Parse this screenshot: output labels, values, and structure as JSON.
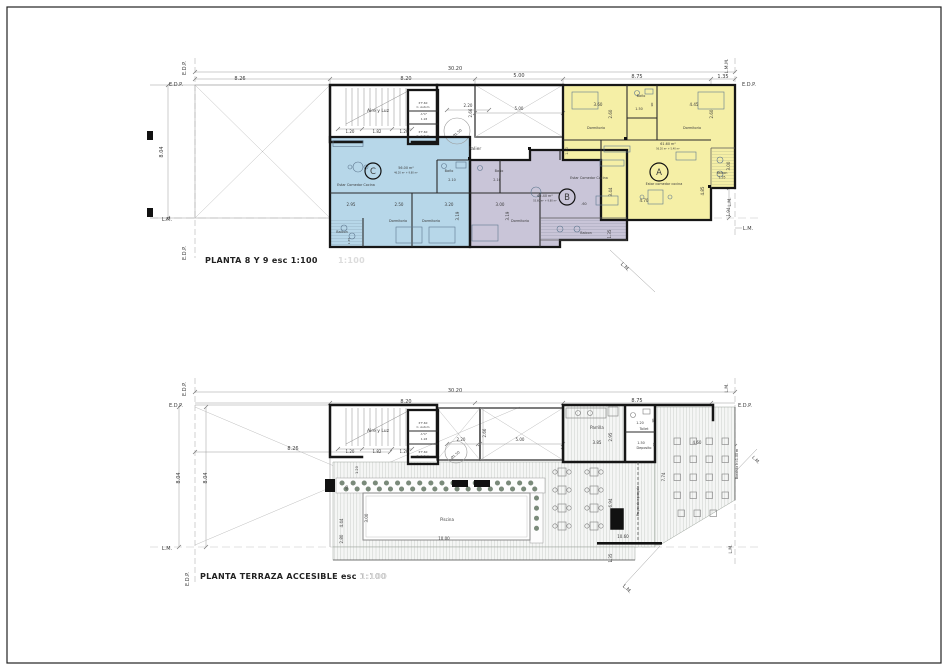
{
  "sheet": {
    "type_note": "architectural floor plan sheet",
    "colors": {
      "unit_a": "#f5efa6",
      "unit_b": "#c9c5d8",
      "unit_c": "#b7d7e9",
      "wall": "#161616",
      "text": "#3a3a3a",
      "ghost": "#dcdcdc"
    }
  },
  "plan1": {
    "title": "PLANTA 8 Y 9 esc 1:100",
    "ghost": "1:100",
    "units": [
      {
        "id": "A",
        "area": "61.60 m²",
        "living": "Estar comedor cocina"
      },
      {
        "id": "B",
        "area": "65.40 m²",
        "living": "Estar Comedor Cocina"
      },
      {
        "id": "C",
        "area": "56.00 m²",
        "living": "Estar Comedor Cocina"
      }
    ],
    "annotations": [
      {
        "t": "E.D.P.",
        "x": 176,
        "y": 86,
        "s": 5
      },
      {
        "t": "E.D.P.",
        "x": 186,
        "y": 68,
        "s": 5,
        "r": -90
      },
      {
        "t": "30.20",
        "x": 455,
        "y": 70,
        "s": 5
      },
      {
        "t": "8.26",
        "x": 240,
        "y": 80,
        "s": 5
      },
      {
        "t": "8.20",
        "x": 406,
        "y": 80,
        "s": 5
      },
      {
        "t": "5.00",
        "x": 519,
        "y": 77,
        "s": 5
      },
      {
        "t": "8.75",
        "x": 637,
        "y": 78,
        "s": 5
      },
      {
        "t": "1.35",
        "x": 723,
        "y": 78,
        "s": 5
      },
      {
        "t": "E.D.P.",
        "x": 749,
        "y": 86,
        "s": 5
      },
      {
        "t": "L.M.M.",
        "x": 728,
        "y": 66,
        "s": 4.5,
        "r": -90
      },
      {
        "t": "8.04",
        "x": 163,
        "y": 152,
        "s": 5,
        "r": -90
      },
      {
        "t": "L.M.",
        "x": 167,
        "y": 221,
        "s": 5
      },
      {
        "t": "E.D.P.",
        "x": 186,
        "y": 253,
        "s": 5,
        "r": -90
      },
      {
        "t": "3.00",
        "x": 730,
        "y": 166,
        "s": 4,
        "r": -90
      },
      {
        "t": "L.M.",
        "x": 731,
        "y": 202,
        "s": 4.5,
        "r": -90
      },
      {
        "t": "1.94",
        "x": 730,
        "y": 212,
        "s": 4,
        "r": -90
      },
      {
        "t": "L.M.",
        "x": 748,
        "y": 230,
        "s": 5
      },
      {
        "t": "L.M.",
        "x": 624,
        "y": 268,
        "s": 5,
        "r": 45
      },
      {
        "t": "Aire y Luz",
        "x": 378,
        "y": 112,
        "s": 4.5
      },
      {
        "t": "1.20",
        "x": 350,
        "y": 133,
        "s": 4
      },
      {
        "t": "1.82",
        "x": 377,
        "y": 133,
        "s": 4
      },
      {
        "t": "1.20",
        "x": 404,
        "y": 133,
        "s": 4
      },
      {
        "t": "P F-60",
        "x": 423,
        "y": 104,
        "s": 2.8
      },
      {
        "t": "C. Autom",
        "x": 423,
        "y": 108,
        "s": 2.8
      },
      {
        "t": "A°C°",
        "x": 424,
        "y": 115,
        "s": 2.8
      },
      {
        "t": "1.18",
        "x": 424,
        "y": 120,
        "s": 2.8
      },
      {
        "t": "P F-60",
        "x": 423,
        "y": 133,
        "s": 2.8
      },
      {
        "t": "C. Autom",
        "x": 423,
        "y": 137,
        "s": 2.8
      },
      {
        "t": "2.20",
        "x": 468,
        "y": 107,
        "s": 4
      },
      {
        "t": "Ø1.50",
        "x": 458,
        "y": 134,
        "s": 3.5,
        "r": -40
      },
      {
        "t": "2.66",
        "x": 472,
        "y": 113,
        "s": 4,
        "r": -90
      },
      {
        "t": "5.00",
        "x": 519,
        "y": 110,
        "s": 4
      },
      {
        "t": "Palier",
        "x": 475,
        "y": 150,
        "s": 4.5
      },
      {
        "t": "C",
        "x": 373,
        "y": 174,
        "s": 8.5
      },
      {
        "t": "56.00 m²",
        "x": 406,
        "y": 169,
        "s": 3.4
      },
      {
        "t": "46.20 m² + 9.80 m²",
        "x": 406,
        "y": 173.5,
        "s": 2.4,
        "c": "#8a8a8a"
      },
      {
        "t": "Estar Comedor Cocina",
        "x": 356,
        "y": 186,
        "s": 3.4
      },
      {
        "t": "2.95",
        "x": 351,
        "y": 206,
        "s": 4
      },
      {
        "t": "2.50",
        "x": 399,
        "y": 206,
        "s": 4
      },
      {
        "t": "3.20",
        "x": 449,
        "y": 206,
        "s": 4
      },
      {
        "t": "Dormitorio",
        "x": 398,
        "y": 222,
        "s": 3.4
      },
      {
        "t": "Dormitorio",
        "x": 431,
        "y": 222,
        "s": 3.4
      },
      {
        "t": "3.19",
        "x": 459,
        "y": 216,
        "s": 4,
        "r": -90
      },
      {
        "t": "Baño",
        "x": 449,
        "y": 172,
        "s": 3.4
      },
      {
        "t": "2.10",
        "x": 452,
        "y": 181,
        "s": 3.4
      },
      {
        "t": "Balcon",
        "x": 342,
        "y": 233,
        "s": 3.4
      },
      {
        "t": "1.35",
        "x": 350,
        "y": 241,
        "s": 3,
        "r": -90
      },
      {
        "t": "Baño",
        "x": 499,
        "y": 172,
        "s": 3.4
      },
      {
        "t": "2.10",
        "x": 497,
        "y": 181,
        "s": 3.4
      },
      {
        "t": "Estar Comedor Cocina",
        "x": 589,
        "y": 179,
        "s": 3.4
      },
      {
        "t": "65.40 m²",
        "x": 545,
        "y": 197,
        "s": 3.4
      },
      {
        "t": "55.60 m² + 9.80 m²",
        "x": 545,
        "y": 201.5,
        "s": 2.4,
        "c": "#8a8a8a"
      },
      {
        "t": "B",
        "x": 567,
        "y": 200,
        "s": 8.5
      },
      {
        "t": ".60",
        "x": 584,
        "y": 205,
        "s": 3.4
      },
      {
        "t": "3.44",
        "x": 612,
        "y": 192,
        "s": 4,
        "r": -90
      },
      {
        "t": "3.00",
        "x": 500,
        "y": 206,
        "s": 4
      },
      {
        "t": "3.19",
        "x": 509,
        "y": 216,
        "s": 4,
        "r": -90
      },
      {
        "t": "Dormitorio",
        "x": 520,
        "y": 222,
        "s": 3.4
      },
      {
        "t": "Balcon",
        "x": 586,
        "y": 234,
        "s": 3.4
      },
      {
        "t": "1.35",
        "x": 611,
        "y": 234,
        "s": 4,
        "r": -90
      },
      {
        "t": "3.60",
        "x": 598,
        "y": 106,
        "s": 4
      },
      {
        "t": "2.60",
        "x": 612,
        "y": 114,
        "s": 4,
        "r": -90
      },
      {
        "t": "Dormitorio",
        "x": 596,
        "y": 129,
        "s": 3.4
      },
      {
        "t": "Baño",
        "x": 641,
        "y": 97,
        "s": 3.4
      },
      {
        "t": "1.50",
        "x": 639,
        "y": 110,
        "s": 3.4
      },
      {
        "t": ".90",
        "x": 653,
        "y": 105,
        "s": 3,
        "r": -90
      },
      {
        "t": "4.45",
        "x": 694,
        "y": 106,
        "s": 4
      },
      {
        "t": "2.60",
        "x": 713,
        "y": 114,
        "s": 4,
        "r": -90
      },
      {
        "t": "Dormitorio",
        "x": 692,
        "y": 129,
        "s": 3.4
      },
      {
        "t": "61.60 m²",
        "x": 668,
        "y": 145,
        "s": 3.4
      },
      {
        "t": "56.20 m² + 5.40 m²",
        "x": 668,
        "y": 149.5,
        "s": 2.4,
        "c": "#8a8a8a"
      },
      {
        "t": "A",
        "x": 659,
        "y": 175,
        "s": 8.5
      },
      {
        "t": "Estar comedor cocina",
        "x": 664,
        "y": 185,
        "s": 3.4
      },
      {
        "t": "4.70",
        "x": 644,
        "y": 202,
        "s": 4
      },
      {
        "t": "4.85",
        "x": 704,
        "y": 191,
        "s": 4,
        "r": -90
      },
      {
        "t": "Balcon",
        "x": 722,
        "y": 174,
        "s": 3.2
      },
      {
        "t": "1.35",
        "x": 722,
        "y": 178.5,
        "s": 3.2
      },
      {
        "t": "1.50",
        "x": 568,
        "y": 151,
        "s": 3.4,
        "r": -90
      }
    ]
  },
  "plan2": {
    "title": "PLANTA TERRAZA ACCESIBLE esc 1:100",
    "ghost": "1:100",
    "annotations": [
      {
        "t": "E.D.P.",
        "x": 186,
        "y": 389,
        "s": 5,
        "r": -90
      },
      {
        "t": "E.D.P.",
        "x": 176,
        "y": 407,
        "s": 5
      },
      {
        "t": "30.20",
        "x": 455,
        "y": 392,
        "s": 5
      },
      {
        "t": "8.20",
        "x": 406,
        "y": 403,
        "s": 5
      },
      {
        "t": "8.75",
        "x": 637,
        "y": 402,
        "s": 5
      },
      {
        "t": "E.D.P.",
        "x": 745,
        "y": 407,
        "s": 5
      },
      {
        "t": "L.M.",
        "x": 728,
        "y": 388,
        "s": 4.5,
        "r": -90
      },
      {
        "t": "8.04",
        "x": 180,
        "y": 478,
        "s": 5,
        "r": -90
      },
      {
        "t": "8.04",
        "x": 207,
        "y": 478,
        "s": 5,
        "r": -90
      },
      {
        "t": "8.26",
        "x": 293,
        "y": 450,
        "s": 5
      },
      {
        "t": "L.M.",
        "x": 167,
        "y": 550,
        "s": 5
      },
      {
        "t": "E.D.P.",
        "x": 189,
        "y": 579,
        "s": 5,
        "r": -90
      },
      {
        "t": "Baranda h=1.00 m",
        "x": 738,
        "y": 464,
        "s": 3.2,
        "r": -90
      },
      {
        "t": "L.M.",
        "x": 755,
        "y": 461,
        "s": 4.5,
        "r": 45
      },
      {
        "t": "L.M.",
        "x": 732,
        "y": 549,
        "s": 4.5,
        "r": -90
      },
      {
        "t": "L.M.",
        "x": 626,
        "y": 590,
        "s": 5,
        "r": 45
      },
      {
        "t": "Aire y Luz",
        "x": 378,
        "y": 432,
        "s": 4.5
      },
      {
        "t": "1.20",
        "x": 350,
        "y": 453,
        "s": 4
      },
      {
        "t": "1.82",
        "x": 377,
        "y": 453,
        "s": 4
      },
      {
        "t": "1.20",
        "x": 404,
        "y": 453,
        "s": 4
      },
      {
        "t": "P F-60",
        "x": 423,
        "y": 424,
        "s": 2.8
      },
      {
        "t": "C. Autom",
        "x": 423,
        "y": 428,
        "s": 2.8
      },
      {
        "t": "A°C°",
        "x": 424,
        "y": 435,
        "s": 2.8
      },
      {
        "t": "1.18",
        "x": 424,
        "y": 440,
        "s": 2.8
      },
      {
        "t": "P F-60",
        "x": 423,
        "y": 453,
        "s": 2.8
      },
      {
        "t": "C. Autom",
        "x": 423,
        "y": 457,
        "s": 2.8
      },
      {
        "t": "2.20",
        "x": 461,
        "y": 441,
        "s": 4
      },
      {
        "t": "Ø1.50",
        "x": 456,
        "y": 456,
        "s": 3.5,
        "r": -40
      },
      {
        "t": "2.66",
        "x": 486,
        "y": 433,
        "s": 4,
        "r": -90
      },
      {
        "t": "5.00",
        "x": 520,
        "y": 441,
        "s": 4
      },
      {
        "t": "1.20",
        "x": 358,
        "y": 470,
        "s": 3.5,
        "r": -90
      },
      {
        "t": ".60",
        "x": 348,
        "y": 488,
        "s": 3.5,
        "r": -90
      },
      {
        "t": "Piscina",
        "x": 447,
        "y": 521,
        "s": 4
      },
      {
        "t": "10.00",
        "x": 444,
        "y": 540,
        "s": 4
      },
      {
        "t": "3.00",
        "x": 368,
        "y": 518,
        "s": 4,
        "r": -90
      },
      {
        "t": "4.44",
        "x": 343,
        "y": 523,
        "s": 4,
        "r": -90
      },
      {
        "t": "2.80",
        "x": 343,
        "y": 539,
        "s": 4,
        "r": -90
      },
      {
        "t": "Parrilla",
        "x": 597,
        "y": 429,
        "s": 4
      },
      {
        "t": "3.85",
        "x": 597,
        "y": 444,
        "s": 4
      },
      {
        "t": "2.95",
        "x": 612,
        "y": 437,
        "s": 4,
        "r": -90
      },
      {
        "t": "Toilet",
        "x": 644,
        "y": 430,
        "s": 3.4
      },
      {
        "t": "1.20",
        "x": 640,
        "y": 424,
        "s": 3.4
      },
      {
        "t": ".90",
        "x": 654,
        "y": 421,
        "s": 3,
        "r": -90
      },
      {
        "t": "Deposito",
        "x": 644,
        "y": 449,
        "s": 3.4
      },
      {
        "t": "1.50",
        "x": 641,
        "y": 444,
        "s": 3.4
      },
      {
        "t": ".90",
        "x": 655,
        "y": 445,
        "s": 3,
        "r": -90
      },
      {
        "t": "7.74",
        "x": 665,
        "y": 477,
        "s": 4,
        "r": -90
      },
      {
        "t": "Proyeccion pergola",
        "x": 639,
        "y": 501,
        "s": 3.2,
        "r": -90
      },
      {
        "t": "4.60",
        "x": 697,
        "y": 444,
        "s": 4
      },
      {
        "t": "6.94",
        "x": 612,
        "y": 503,
        "s": 4,
        "r": -90
      },
      {
        "t": "10.60",
        "x": 623,
        "y": 538,
        "s": 4
      },
      {
        "t": "1.35",
        "x": 612,
        "y": 558,
        "s": 4,
        "r": -90
      }
    ]
  }
}
